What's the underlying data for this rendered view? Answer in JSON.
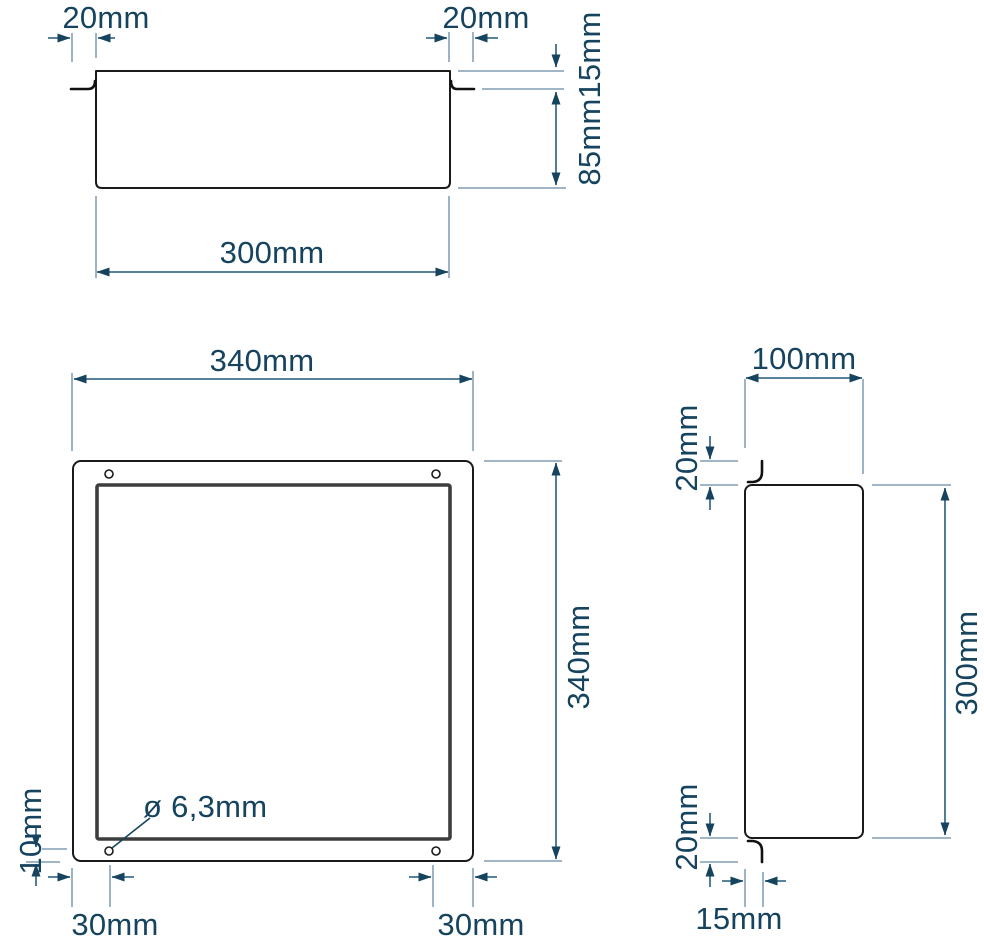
{
  "drawing": {
    "background": "#ffffff",
    "colors": {
      "outline": "#1a1a1a",
      "frame_inner": "#3d3d3d",
      "dimension_line": "#3f6f8f",
      "extension_line": "#93abbf",
      "arrow": "#16435e",
      "text": "#16435e"
    },
    "views": {
      "top": {
        "labels": {
          "flange_left": "20mm",
          "flange_right": "20mm",
          "lip_depth": "15mm",
          "body_depth": "85mm",
          "opening_width": "300mm"
        }
      },
      "front": {
        "labels": {
          "overall_width": "340mm",
          "overall_height": "340mm",
          "hole_diameter": "ø 6,3mm",
          "hole_offset_left": "30mm",
          "hole_offset_right": "30mm",
          "hole_offset_bottom": "10mm"
        }
      },
      "side": {
        "labels": {
          "body_depth": "100mm",
          "flange_top": "20mm",
          "flange_bottom": "20mm",
          "body_height": "300mm",
          "flange_inset": "15mm"
        }
      }
    }
  }
}
